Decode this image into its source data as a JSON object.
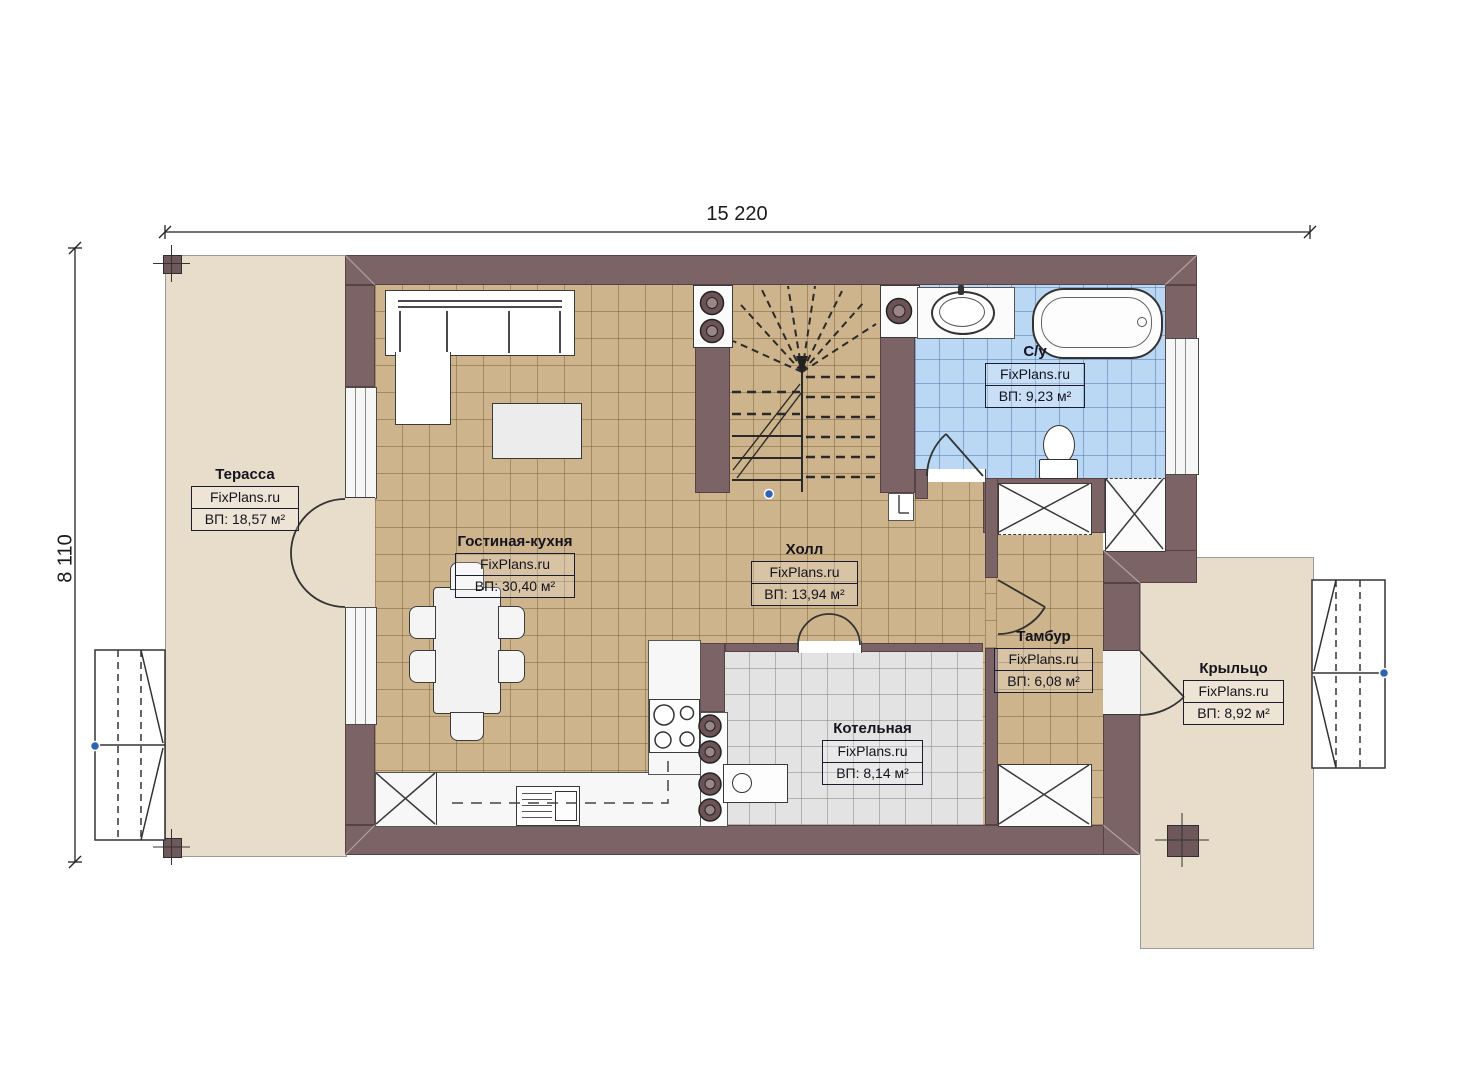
{
  "watermark": "FixPlans.ru",
  "dimensions": {
    "overall_width": "15 220",
    "overall_height": "8 110"
  },
  "rooms": [
    {
      "name": "Терасса",
      "area": "ВП: 18,57 м²"
    },
    {
      "name": "Гостиная-кухня",
      "area": "ВП: 30,40 м²"
    },
    {
      "name": "Холл",
      "area": "ВП: 13,94 м²"
    },
    {
      "name": "С/у",
      "area": "ВП: 9,23 м²"
    },
    {
      "name": "Тамбур",
      "area": "ВП: 6,08 м²"
    },
    {
      "name": "Котельная",
      "area": "ВП: 8,14 м²"
    },
    {
      "name": "Крыльцо",
      "area": "ВП: 8,92 м²"
    }
  ],
  "colors": {
    "wall": "#7b6366",
    "living_tile": "#cdb48c",
    "bath_tile": "#bad7f3",
    "boiler_tile": "#e3e3e3",
    "outdoor": "#e8ddca",
    "marker_dot": "#2f62b5"
  }
}
